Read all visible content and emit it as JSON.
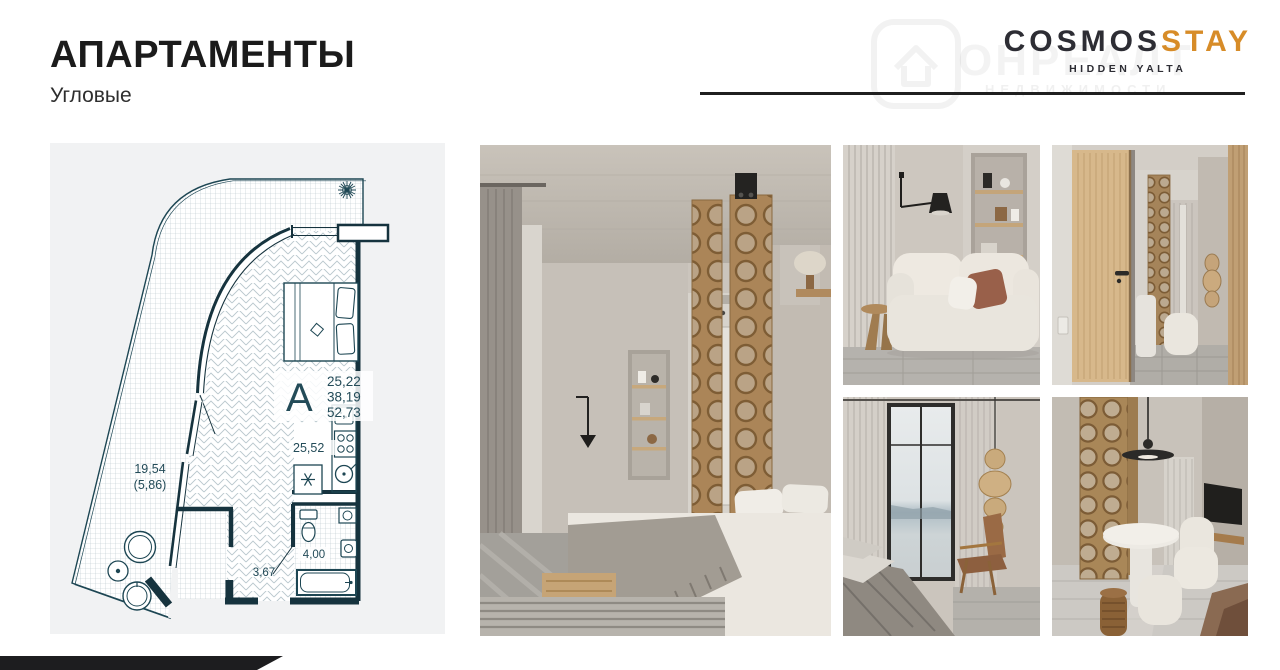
{
  "slide": {
    "background": "#ffffff"
  },
  "header": {
    "title": "АПАРТАМЕНТЫ",
    "subtitle": "Угловые"
  },
  "logo": {
    "brand_primary": "COSMOS",
    "brand_accent": "STAY",
    "tagline": "HIDDEN YALTA",
    "accent_color": "#d78c28",
    "text_color": "#2d2d34"
  },
  "watermark": {
    "main": "ОНРЕАЛТ",
    "sub": "НЕДВИЖИМОСТИ"
  },
  "floor_plan": {
    "unit_letter": "А",
    "total_area_lines": [
      "25,22",
      "38,19",
      "52,73"
    ],
    "room_area": "25,52",
    "terrace_area": "19,54",
    "terrace_area_reduced": "(5,86)",
    "hall_area": "3,67",
    "bathroom_area": "4,00",
    "line_color": "#16424f",
    "pattern_color": "#b9c7cd",
    "card_background": "#f1f2f3"
  },
  "photos": [
    {
      "name": "bedroom-overview"
    },
    {
      "name": "sofa-niche"
    },
    {
      "name": "entry-hallway"
    },
    {
      "name": "bedroom-window"
    },
    {
      "name": "dining-nook"
    }
  ]
}
